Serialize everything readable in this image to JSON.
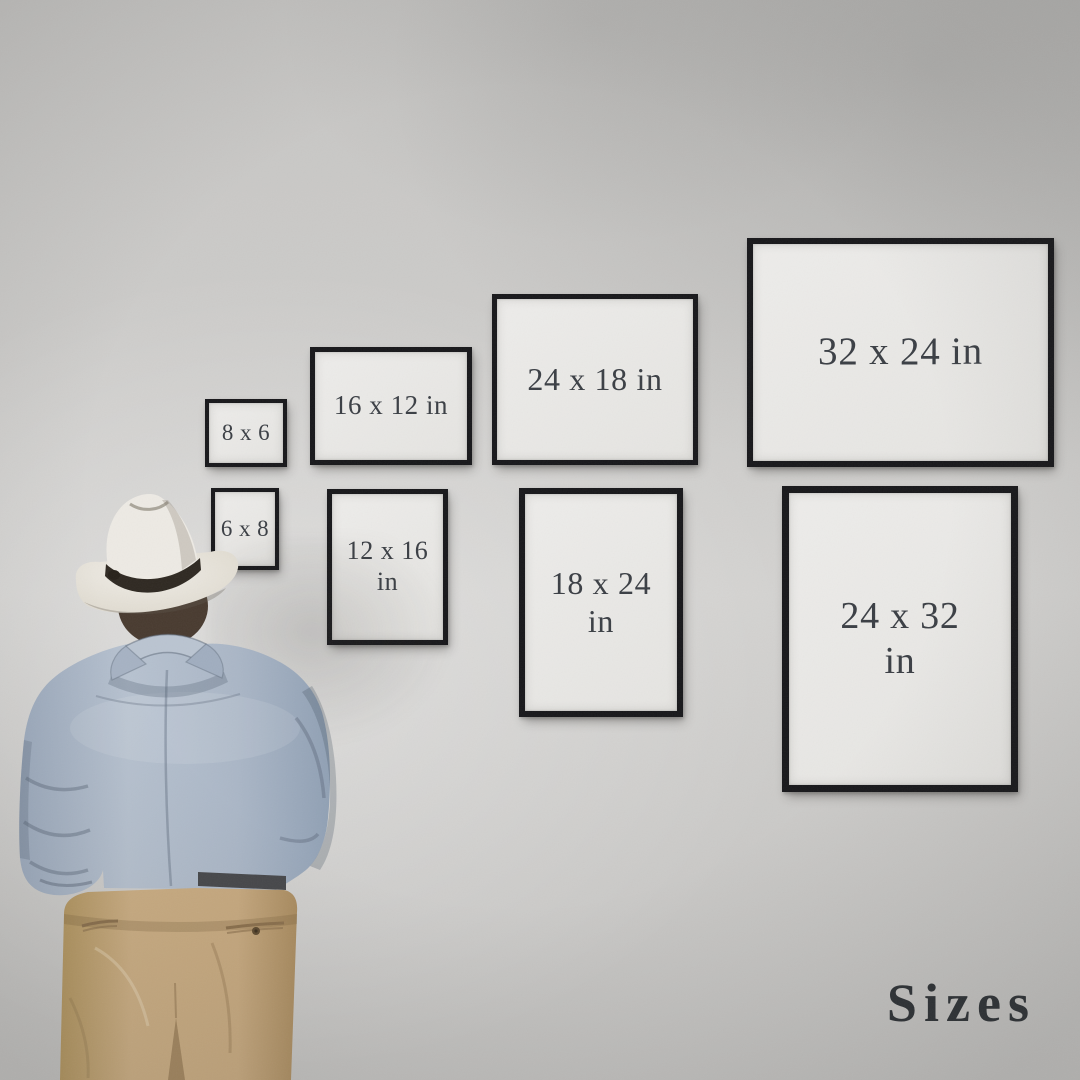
{
  "caption": {
    "text": "Sizes"
  },
  "frames": [
    {
      "id": "8x6",
      "label": "8 x 6",
      "orientation": "landscape"
    },
    {
      "id": "16x12",
      "label": "16 x 12 in",
      "orientation": "landscape"
    },
    {
      "id": "24x18",
      "label": "24 x 18 in",
      "orientation": "landscape"
    },
    {
      "id": "32x24",
      "label": "32 x 24 in",
      "orientation": "landscape"
    },
    {
      "id": "6x8",
      "label": "6 x 8",
      "orientation": "portrait"
    },
    {
      "id": "12x16",
      "label": "12 x 16\nin",
      "orientation": "portrait"
    },
    {
      "id": "18x24",
      "label": "18 x 24\nin",
      "orientation": "portrait"
    },
    {
      "id": "24x32",
      "label": "24 x 32\nin",
      "orientation": "portrait"
    }
  ],
  "colors": {
    "wall": "#cbcac8",
    "frame_border": "#17171a",
    "frame_paper": "#e9e8e6",
    "label_text": "#3a3e44",
    "caption_text": "#2c3034",
    "shirt": "#aab6c6",
    "pants": "#c3a57d",
    "hat": "#e9e6e0",
    "hat_band": "#2e2821",
    "hair": "#483a2f"
  }
}
